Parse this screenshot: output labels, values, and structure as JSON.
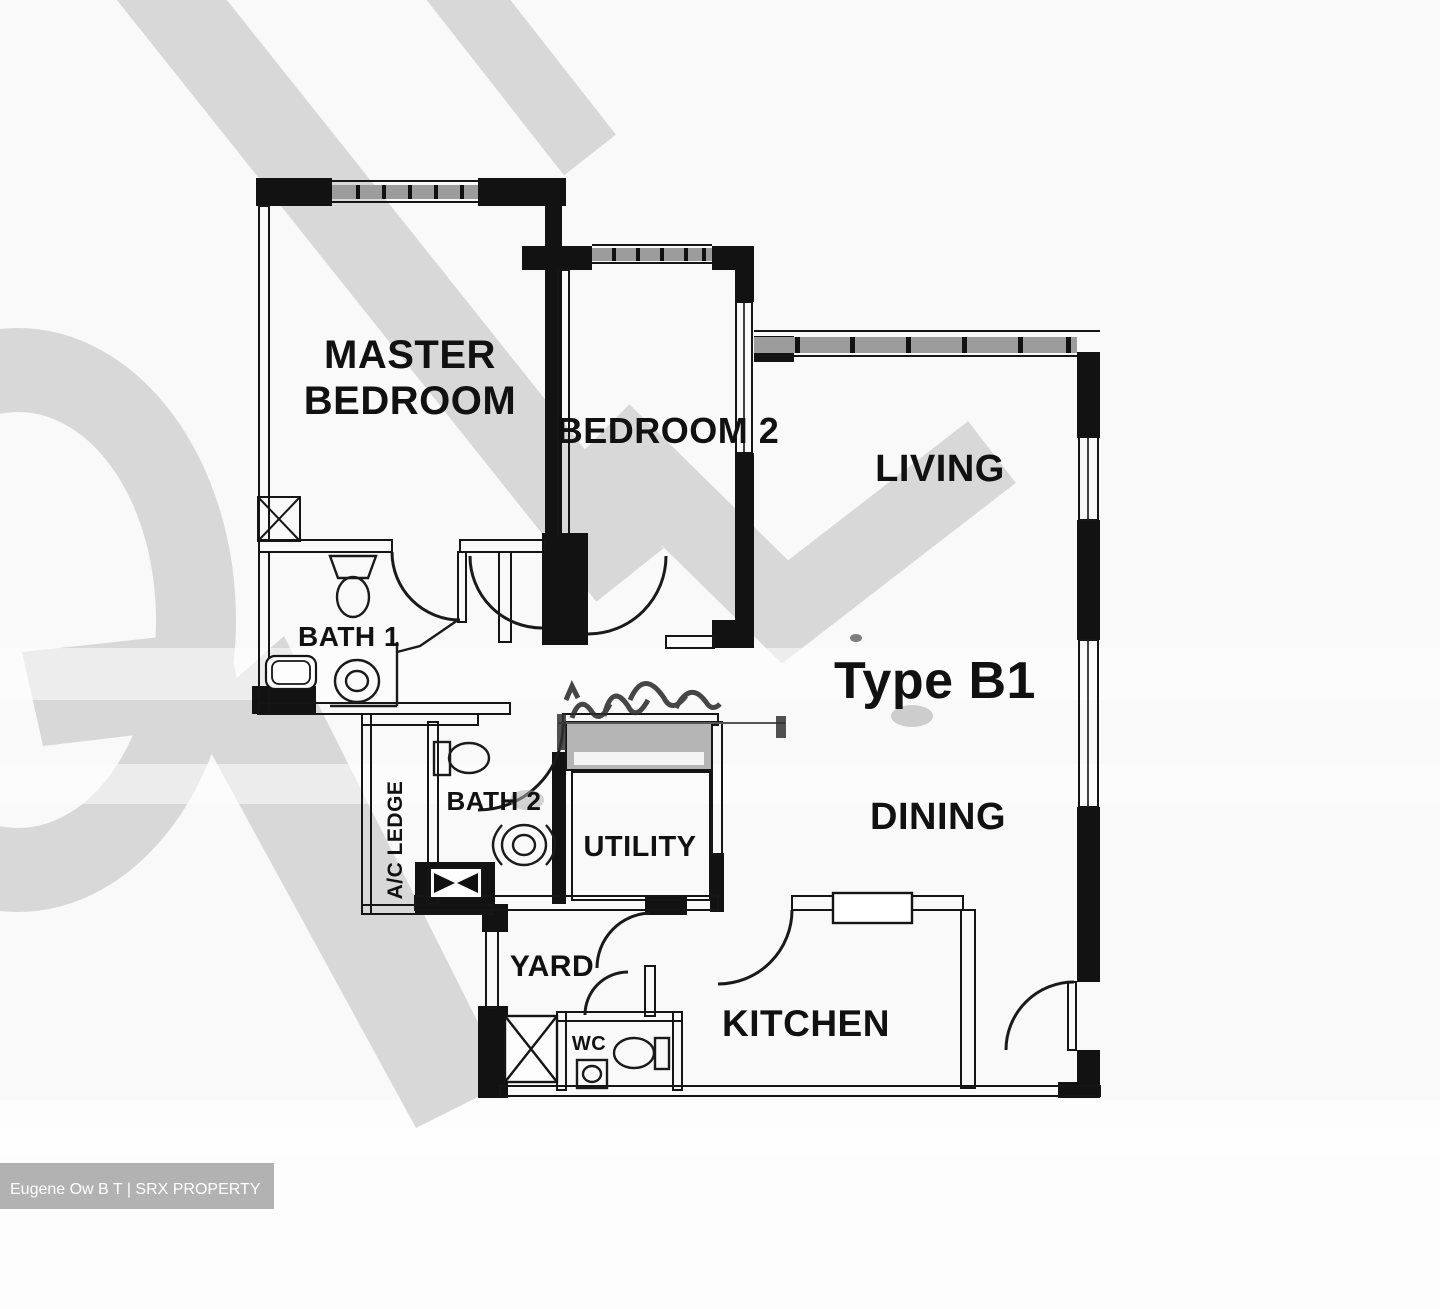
{
  "plan": {
    "unit_type_label": "Type B1",
    "rooms": {
      "master_bedroom": {
        "line1": "MASTER",
        "line2": "BEDROOM"
      },
      "bedroom2": {
        "label": "BEDROOM 2"
      },
      "living": {
        "label": "LIVING"
      },
      "dining": {
        "label": "DINING"
      },
      "kitchen": {
        "label": "KITCHEN"
      },
      "bath1": {
        "label": "BATH 1"
      },
      "bath2": {
        "label": "BATH 2"
      },
      "utility": {
        "label": "UTILITY"
      },
      "yard": {
        "label": "YARD"
      },
      "wc": {
        "label": "WC"
      },
      "ac_ledge": {
        "label": "A/C LEDGE"
      }
    }
  },
  "watermark": {
    "credit": "Eugene Ow B T | SRX PROPERTY"
  },
  "colors": {
    "wall": "#121212",
    "watermark_gray": "#d8d8d8",
    "window_band": "#9c9c9c",
    "credit_bar_bg": "#b2b2b2",
    "credit_text": "#ffffff"
  }
}
